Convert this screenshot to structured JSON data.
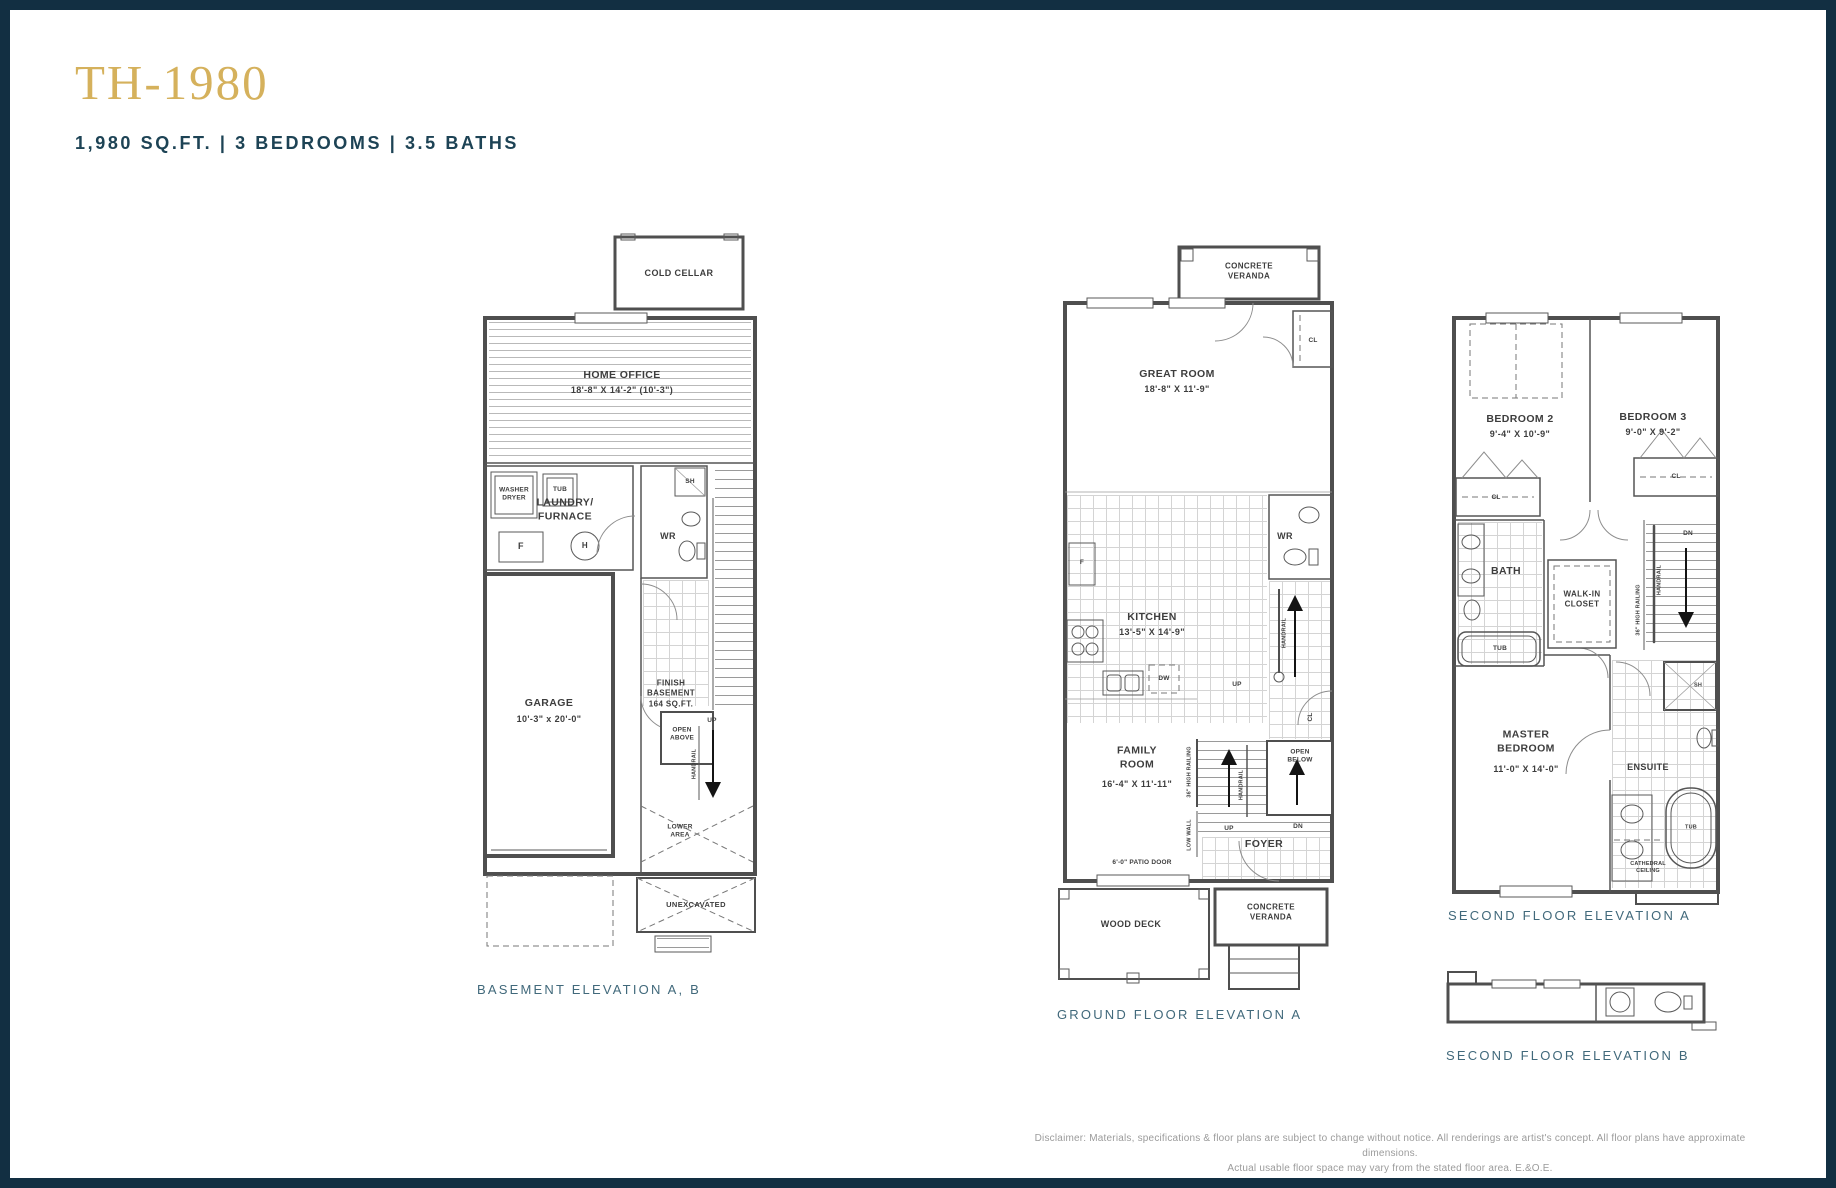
{
  "page": {
    "title": "TH-1980",
    "subtitle": "1,980 SQ.FT. | 3 BEDROOMS | 3.5 BATHS",
    "disclaimer_line1": "Disclaimer: Materials, specifications & floor plans are subject to change without notice. All renderings are artist's concept. All floor plans have approximate dimensions.",
    "disclaimer_line2": "Actual usable floor space may vary from the stated floor area. E.&O.E."
  },
  "colors": {
    "accent_gold": "#D5B15C",
    "navy_border": "#122F42",
    "subtitle_navy": "#1D4355",
    "caption_teal": "#41697B",
    "plan_line_gray": "#4F4F4F",
    "disclaimer_gray": "#9B9B9B"
  },
  "basement": {
    "caption": "BASEMENT ELEVATION A, B",
    "labels": {
      "cold_cellar": "COLD CELLAR",
      "home_office": "HOME OFFICE",
      "home_office_dims": "18'-8\" X 14'-2\" (10'-3\")",
      "washer_dryer": "WASHER\nDRYER",
      "tub": "TUB",
      "laundry_furnace": "LAUNDRY/\nFURNACE",
      "furnace_f": "F",
      "hwt_h": "H",
      "shower_sh": "SH",
      "wr": "WR",
      "garage": "GARAGE",
      "garage_dims": "10'-3\" x 20'-0\"",
      "finish_basement": "FINISH\nBASEMENT\n164 SQ.FT.",
      "open_above": "OPEN\nABOVE",
      "up": "UP",
      "handrail": "HANDRAIL",
      "lower_area": "LOWER\nAREA",
      "unexcavated": "UNEXCAVATED"
    }
  },
  "ground": {
    "caption": "GROUND FLOOR ELEVATION A",
    "labels": {
      "concrete_veranda_top": "CONCRETE\nVERANDA",
      "great_room": "GREAT ROOM",
      "great_room_dims": "18'-8\" X 11'-9\"",
      "cl_top": "CL",
      "wr": "WR",
      "fridge_f": "F",
      "kitchen": "KITCHEN",
      "kitchen_dims": "13'-5\" X 14'-9\"",
      "dw": "DW",
      "up_kitchen": "UP",
      "handrail_upper": "HANDRAIL",
      "cl_right": "CL",
      "family_room": "FAMILY\nROOM",
      "family_room_dims": "16'-4\" X 11'-11\"",
      "high_railing": "36\" HIGH RAILING",
      "low_wall": "LOW WALL",
      "handrail_lower": "HANDRAIL",
      "open_below": "OPEN\nBELOW",
      "up_foyer": "UP",
      "dn_foyer": "DN",
      "foyer": "FOYER",
      "patio_door": "6'-0\" PATIO DOOR",
      "wood_deck": "WOOD DECK",
      "concrete_veranda_bottom": "CONCRETE\nVERANDA"
    }
  },
  "second_a": {
    "caption": "SECOND FLOOR ELEVATION A",
    "labels": {
      "bedroom2": "BEDROOM 2",
      "bedroom2_dims": "9'-4\" X 10'-9\"",
      "bedroom3": "BEDROOM 3",
      "bedroom3_dims": "9'-0\" X 9'-2\"",
      "cl_left": "CL",
      "cl_right": "CL",
      "bath": "BATH",
      "tub_bath": "TUB",
      "walk_in_closet": "WALK-IN\nCLOSET",
      "dn": "DN",
      "handrail": "HANDRAIL",
      "high_railing": "36\" HIGH RAILING",
      "master_bedroom": "MASTER\nBEDROOM",
      "master_bedroom_dims": "11'-0\" X 14'-0\"",
      "ensuite": "ENSUITE",
      "shower_sh": "SH",
      "tub_ensuite": "TUB",
      "cathedral_ceiling": "CATHEDRAL\nCEILING"
    }
  },
  "second_b": {
    "caption": "SECOND FLOOR ELEVATION B"
  }
}
